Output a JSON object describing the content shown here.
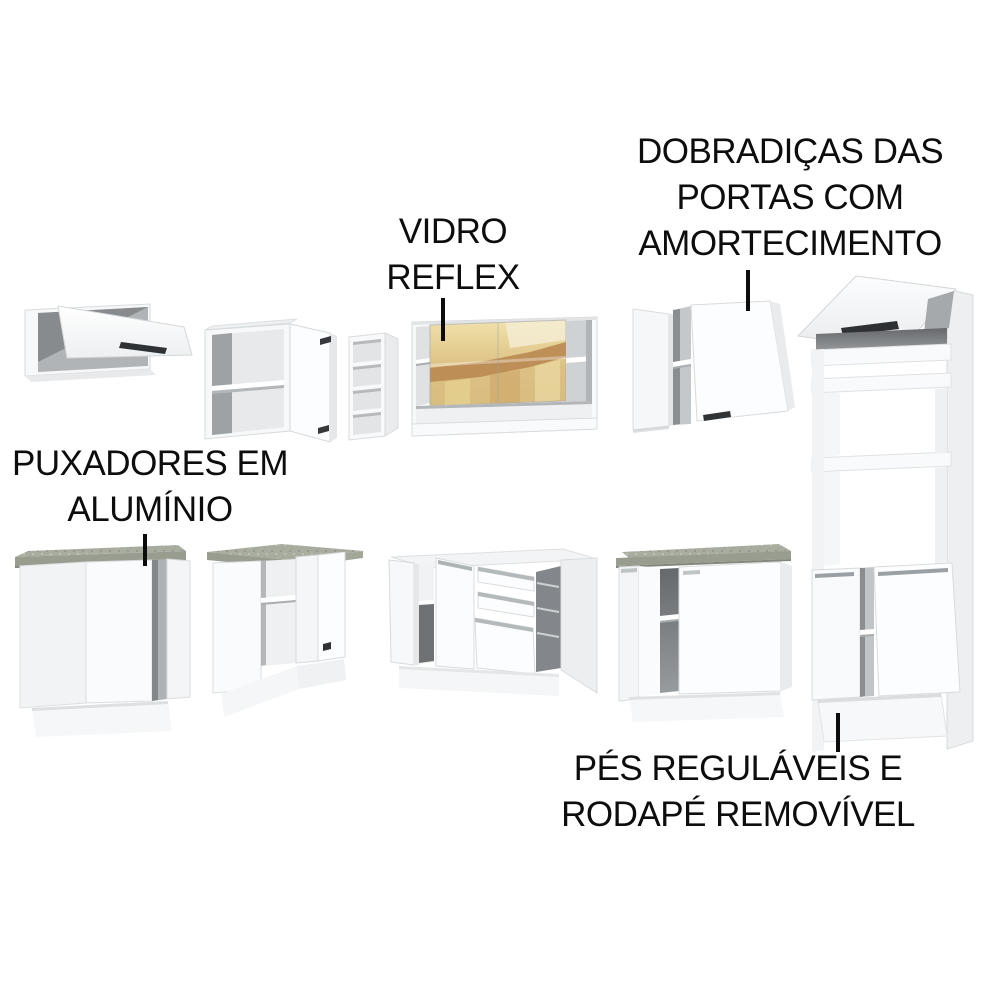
{
  "annotations": {
    "door_hinges": {
      "text": "DOBRADIÇAS DAS PORTAS COM AMORTECIMENTO",
      "lines": [
        "DOBRADIÇAS DAS",
        "PORTAS COM",
        "AMORTECIMENTO"
      ]
    },
    "reflex_glass": {
      "text": "VIDRO REFLEX",
      "lines": [
        "VIDRO",
        "REFLEX"
      ]
    },
    "aluminum_handles": {
      "text": "PUXADORES EM ALUMÍNIO",
      "lines": [
        "PUXADORES EM",
        "ALUMÍNIO"
      ]
    },
    "adjustable_feet": {
      "text": "PÉS REGULÁVEIS E RODAPÉ REMOVÍVEL",
      "lines": [
        "PÉS REGULÁVEIS E",
        "RODAPÉ REMOVÍVEL"
      ]
    }
  },
  "colors": {
    "background": "#ffffff",
    "annotation_text": "#0d0d0d",
    "annotation_line": "#0c0c0c",
    "cabinet_white": "#fbfcfd",
    "cabinet_shade": "#eceef0",
    "interior_dark": "#6f7275",
    "handle_dark": "#2f3235",
    "aluminum_profile": "#9aa0a4",
    "countertop_granite": "#a9ad9f",
    "glass_gold_light": "#f0e2ab",
    "glass_gold_amber": "#b98a52"
  }
}
